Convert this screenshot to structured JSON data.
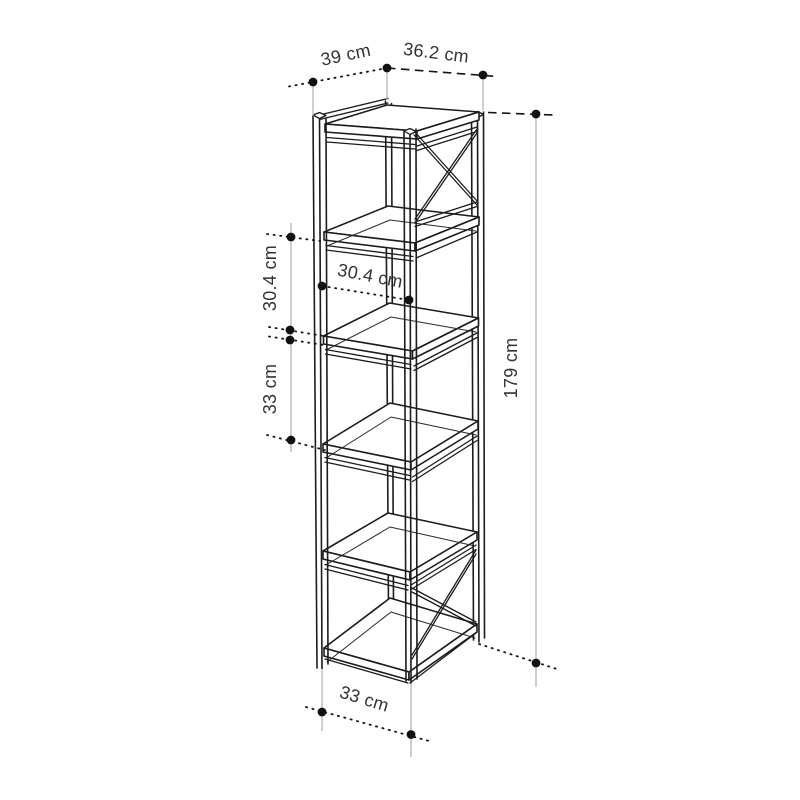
{
  "diagram": {
    "subject": "tall 5-compartment bookcase line drawing with dimension annotations",
    "unit": "cm",
    "shelf_count": 6,
    "open_compartments": 5,
    "cross_braced_side_cells": [
      "top",
      "bottom"
    ]
  },
  "labels": {
    "depth_top": "39 cm",
    "width_top": "36.2 cm",
    "compartment_height_left": "30.4 cm",
    "shelf_spacing_left": "33 cm",
    "compartment_width_inner": "30.4 cm",
    "overall_height_right": "179 cm",
    "base_width_bottom": "33 cm"
  },
  "colors": {
    "background": "#ffffff",
    "drawing_line": "#1c1c1c",
    "extension_line": "#b5b5b5",
    "dimension_line": "#141414",
    "marker_dot": "#111111",
    "label_text": "#333333"
  }
}
